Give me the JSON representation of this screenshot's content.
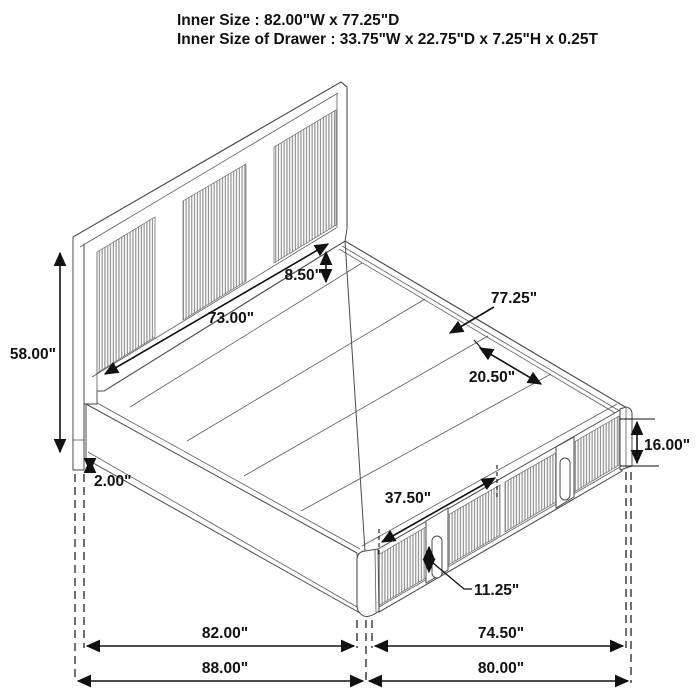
{
  "title": {
    "line1": "Inner Size : 82.00\"W x 77.25\"D",
    "line2": "Inner Size of Drawer : 33.75\"W x 22.75\"D x 7.25\"H x 0.25T"
  },
  "dimensions": {
    "headboard_height": "58.00\"",
    "leg_clearance": "2.00\"",
    "headboard_inner_width": "73.00\"",
    "headboard_ledge_depth": "8.50\"",
    "platform_inner_depth": "77.25\"",
    "deck_panel_width": "20.50\"",
    "platform_height": "16.00\"",
    "drawer_front_width": "37.50\"",
    "drawer_handle_height": "11.25\"",
    "inner_width": "82.00\"",
    "side_inner_depth": "74.50\"",
    "overall_width": "88.00\"",
    "overall_depth": "80.00\""
  },
  "colors": {
    "background": "#ffffff",
    "line_art": "#4a4a4a",
    "dimension_ink": "#111111",
    "slat_gray": "#8d8d8d"
  }
}
